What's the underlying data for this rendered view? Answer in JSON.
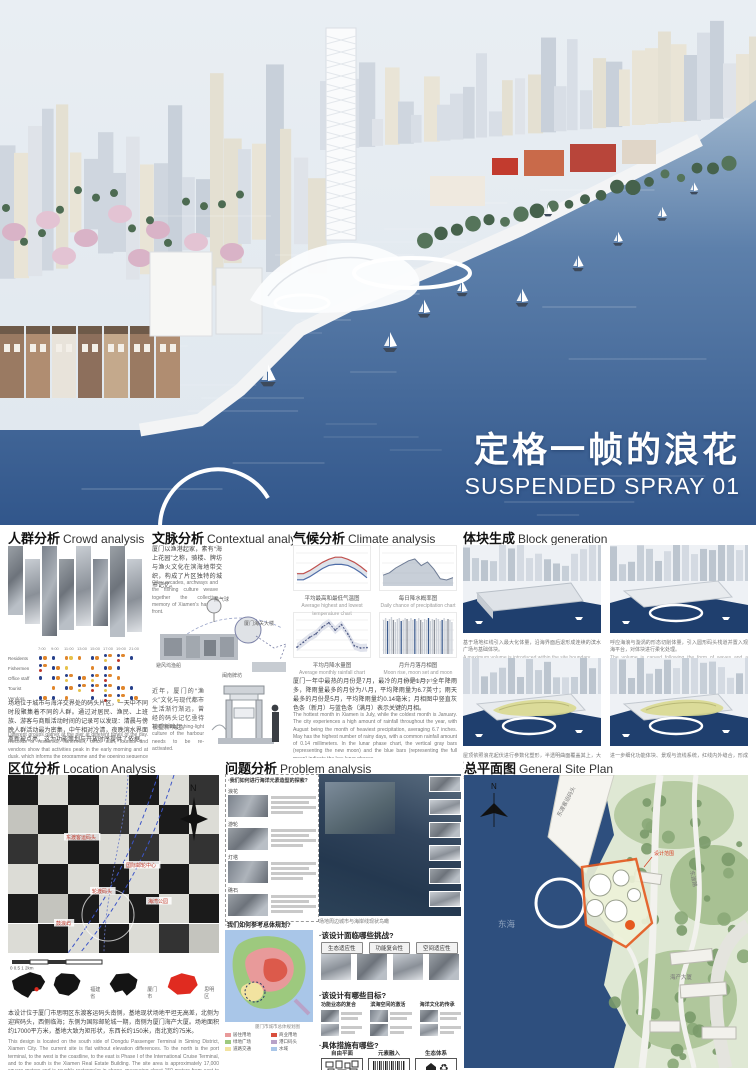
{
  "poster": {
    "title_cn": "定格一帧的浪花",
    "title_en": "SUSPENDED SPRAY 01"
  },
  "sections": {
    "crowd": {
      "title_cn": "人群分析",
      "title_en": "Crowd analysis",
      "matrix": {
        "times": [
          "7:00",
          "9:00",
          "11:00",
          "13:00",
          "15:00",
          "17:00",
          "19:00",
          "21:00"
        ],
        "rows": [
          {
            "label": "Residents",
            "dots": [
              "bo",
              "b",
              "oy",
              "o",
              "bo",
              "boy",
              "bor",
              "b"
            ]
          },
          {
            "label": "Fishermen",
            "dots": [
              "bor",
              "bo",
              "y",
              "",
              "o",
              "bo",
              "b",
              ""
            ]
          },
          {
            "label": "Office staff",
            "dots": [
              "b",
              "bo",
              "boy",
              "bo",
              "boy",
              "bor",
              "o",
              ""
            ]
          },
          {
            "label": "Tourist",
            "dots": [
              "",
              "o",
              "bo",
              "boy",
              "bor",
              "boy",
              "bo",
              "b"
            ]
          },
          {
            "label": "Vendors",
            "dots": [
              "bo",
              "b",
              "o",
              "",
              "b",
              "bor",
              "boy",
              "bo"
            ]
          }
        ],
        "dot_colors": {
          "b": "#27408b",
          "o": "#e0862c",
          "r": "#c0392b",
          "y": "#e7c24a"
        }
      },
      "para_cn": "场地位于城市与海洋交界处的码头片区，一天中不同时段聚集着不同的人群。通过对居民、渔民、上班族、游客与商贩活动时间的记录可以发现：清晨与傍晚人群活动最为密集，中午相对冷清，夜晚滨水界面重新被点亮，这为功能策划与开放时序提供了依据。",
      "para_en": "Different groups gather at the pier at different times of the day. Records of residents, fishermen, office staff, tourists and vendors show that activities peak in the early morning and at dusk, which informs the programme and the opening sequence of the design."
    },
    "contextual": {
      "title_cn": "文脉分析",
      "title_en": "Contextual analysis",
      "intro_cn": "厦门以渔港起家，素有“海上花园”之称，骑楼、牌坊与渔火文化在滨海地带交织，构成了片区独特的城市记忆。",
      "intro_en": "Qilou arcades, archways and the fishing culture weave together the collective memory of Xiamen's harbour front.",
      "labels": [
        "热气球",
        "厦门海关大楼",
        "避风坞渔船",
        "闽南牌坊"
      ],
      "note_cn": "近年，厦门的“渔火”文化与现代都市生活渐行渐远，曾经的码头记忆亟待被重新唤起。",
      "note_en": "The fading fishing-light culture of the harbour needs to be re-activated."
    },
    "climate": {
      "title_cn": "气候分析",
      "title_en": "Climate analysis",
      "para_cn": "厦门一年中最热的月份是7月，最冷的月份是1月；全年降雨多，降雨量最多的月份为八月，平均降雨量为6.7英寸；雨天最多的月份是5月，平均降雨量约0.14毫米；月相图中竖直灰色条（新月）与蓝色条（满月）表示关键的月相。",
      "para_en": "The hottest month in Xiamen is July, while the coldest month is January. The city experiences a high amount of rainfall throughout the year, with August being the month of heaviest precipitation, averaging 6.7 inches. May has the highest number of rainy days, with a common rainfall amount of 0.14 millimeters. In the lunar phase chart, the vertical gray bars (representing the new moon) and the blue bars (representing the full moon) indicate the key lunar phases."
    },
    "block": {
      "title_cn": "体块生成",
      "title_en": "Block generation",
      "steps": [
        {
          "caption_cn": "基于场地红线引入最大化体量，沿海界面后退形成连续的滨水广场与基础体块。",
          "caption_en": "A maximum volume is introduced within the site boundary."
        },
        {
          "caption_cn": "呼应海浪与漩涡的形态切削体量，引入圆形码头栈道并置入观海平台，对体块进行柔化处理。",
          "caption_en": "The volume is carved following the form of waves and a circular pier is added."
        },
        {
          "caption_cn": "屋顶依照浪花起伏进行参数化塑形，半透明曲面覆盖其上，大小不同的天窗引入光线。",
          "caption_en": "The roof is shaped parametrically like suspended spray, with skylights bringing in light."
        },
        {
          "caption_cn": "进一步细化功能体块、景观与流线系统，红线内外缝合，形成最终“定格浪花”的建筑形态。",
          "caption_en": "Programme, landscape and circulation are refined to form the final frozen-spray massing."
        }
      ]
    },
    "location": {
      "title_cn": "区位分析",
      "title_en": "Location Analysis",
      "map_labels": [
        "东渡客运码头",
        "国际邮轮中心",
        "轮渡码头",
        "海湾公园",
        "鼓浪屿"
      ],
      "north": "N",
      "scale": [
        "0",
        "0.5",
        "1",
        "2km"
      ],
      "maps": [
        {
          "label": ""
        },
        {
          "label": "福建省"
        },
        {
          "label": "厦门市"
        },
        {
          "label": "思明区"
        }
      ],
      "para_cn": "本设计位于厦门市思明区东渡客运码头南侧，基地现状场地平坦无高差，北侧为迎宾码头，西侧临海；东侧为国际邮轮城一期，南侧为厦门海产大厦。场地面积约17000平方米，基地大致为矩形状，东西长约150米，南北宽约75米。",
      "para_en": "This design is located on the south side of Dongdu Passenger Terminal in Siming District, Xiamen City. The current site is flat without elevation differences. To the north is the port terminal, to the west is the coastline, to the east is Phase I of the International Cruise Terminal, and to the south is the Xiamen Real Estate Building. The site area is approximately 17,000 square meters and is roughly rectangular in shape, measuring about 150 meters from east to west, and 75 meters from north to south."
    },
    "problem": {
      "title_cn": "问题分析",
      "title_en": "Problem analysis",
      "explore_title": "·我们如何进行海洋元素造型的探索?",
      "explore_rows": [
        {
          "label": "浪花"
        },
        {
          "label": "游轮"
        },
        {
          "label": "灯塔"
        },
        {
          "label": "礁石"
        }
      ],
      "aerial_caption": "场地周边城市与海岸线现状鸟瞰",
      "challenges_q": "·该设计面临哪些挑战?",
      "challenges": [
        "生态适应性",
        "功能复合性",
        "空间适应性",
        "文化延续性"
      ],
      "goals_q": "·该设计有哪些目标?",
      "goals": [
        "功能业态的复合",
        "滨海空间的激活",
        "海洋文化的传承"
      ],
      "measures_q": "·具体措施有哪些?",
      "measures": [
        "自由平面",
        "元素融入",
        "生态体系"
      ],
      "masterplan_q": "·我们如何参考总体规划?",
      "masterplan_caption": "厦门市城市总体规划图",
      "legend": [
        {
          "label": "居住用地",
          "color": "#e89a9a"
        },
        {
          "label": "商业用地",
          "color": "#d94f3d"
        },
        {
          "label": "绿地广场",
          "color": "#9dc97e"
        },
        {
          "label": "港口码头",
          "color": "#b8a2c8"
        },
        {
          "label": "道路交通",
          "color": "#f2e3a0"
        },
        {
          "label": "水域",
          "color": "#a9c6e8"
        }
      ]
    },
    "siteplan": {
      "title_cn": "总平面图",
      "title_en": "General Site Plan",
      "labels": {
        "terminal": "东渡客运码头",
        "road": "东渡路",
        "sea": "东海",
        "building": "海产大厦",
        "boundary": "设计范围",
        "north": "N"
      }
    }
  },
  "chart_data": [
    {
      "type": "line",
      "title": "平均最高和最低气温图",
      "subtitle": "Average highest and lowest temperature chart",
      "x": [
        "Jan",
        "Feb",
        "Mar",
        "Apr",
        "May",
        "Jun",
        "Jul",
        "Aug",
        "Sep",
        "Oct",
        "Nov",
        "Dec"
      ],
      "series": [
        {
          "name": "平均最高气温",
          "color": "#c0504d",
          "values": [
            17,
            17,
            20,
            24,
            28,
            31,
            33,
            33,
            31,
            28,
            24,
            19
          ]
        },
        {
          "name": "平均最低气温",
          "color": "#4f6da8",
          "values": [
            11,
            11,
            14,
            18,
            22,
            25,
            26,
            26,
            25,
            22,
            18,
            13
          ]
        }
      ],
      "ylabel": "°C",
      "ylim": [
        5,
        40
      ]
    },
    {
      "type": "area",
      "title": "每日降水概率图",
      "subtitle": "Daily chance of precipitation chart",
      "x": [
        "Jan",
        "Feb",
        "Mar",
        "Apr",
        "May",
        "Jun",
        "Jul",
        "Aug",
        "Sep",
        "Oct",
        "Nov",
        "Dec"
      ],
      "values": [
        18,
        22,
        30,
        36,
        42,
        45,
        34,
        40,
        28,
        12,
        10,
        14
      ],
      "ylim": [
        0,
        60
      ],
      "color": "#9aa7b8"
    },
    {
      "type": "line",
      "title": "平均月降水量图",
      "subtitle": "Average monthly rainfall chart",
      "x": [
        "Jan",
        "Feb",
        "Mar",
        "Apr",
        "May",
        "Jun",
        "Jul",
        "Aug",
        "Sep",
        "Oct",
        "Nov",
        "Dec"
      ],
      "values": [
        1.3,
        2.4,
        3.5,
        4.3,
        5.8,
        6.7,
        5.1,
        6.3,
        4.2,
        1.6,
        1.1,
        1.2
      ],
      "ylim": [
        0,
        8
      ],
      "color": "#55608a"
    },
    {
      "type": "bar",
      "title": "月升月落月相图",
      "subtitle": "Moon rise, moon set and moon phases chart",
      "bars": [
        34,
        36,
        33,
        35,
        37,
        34,
        32,
        35,
        36,
        33,
        34,
        36,
        35,
        33,
        36,
        34,
        35,
        33,
        36,
        34,
        32,
        35,
        34,
        36,
        33,
        35,
        34,
        36,
        35,
        33,
        34,
        36,
        33,
        35,
        34,
        32
      ],
      "full_moon_idx": [
        2,
        9,
        16,
        23,
        30
      ],
      "new_moon_idx": [
        5,
        12,
        19,
        26,
        33
      ],
      "colors": {
        "normal": "#c9ced6",
        "full": "#3a5a8c",
        "new": "#8a8f98"
      }
    }
  ]
}
